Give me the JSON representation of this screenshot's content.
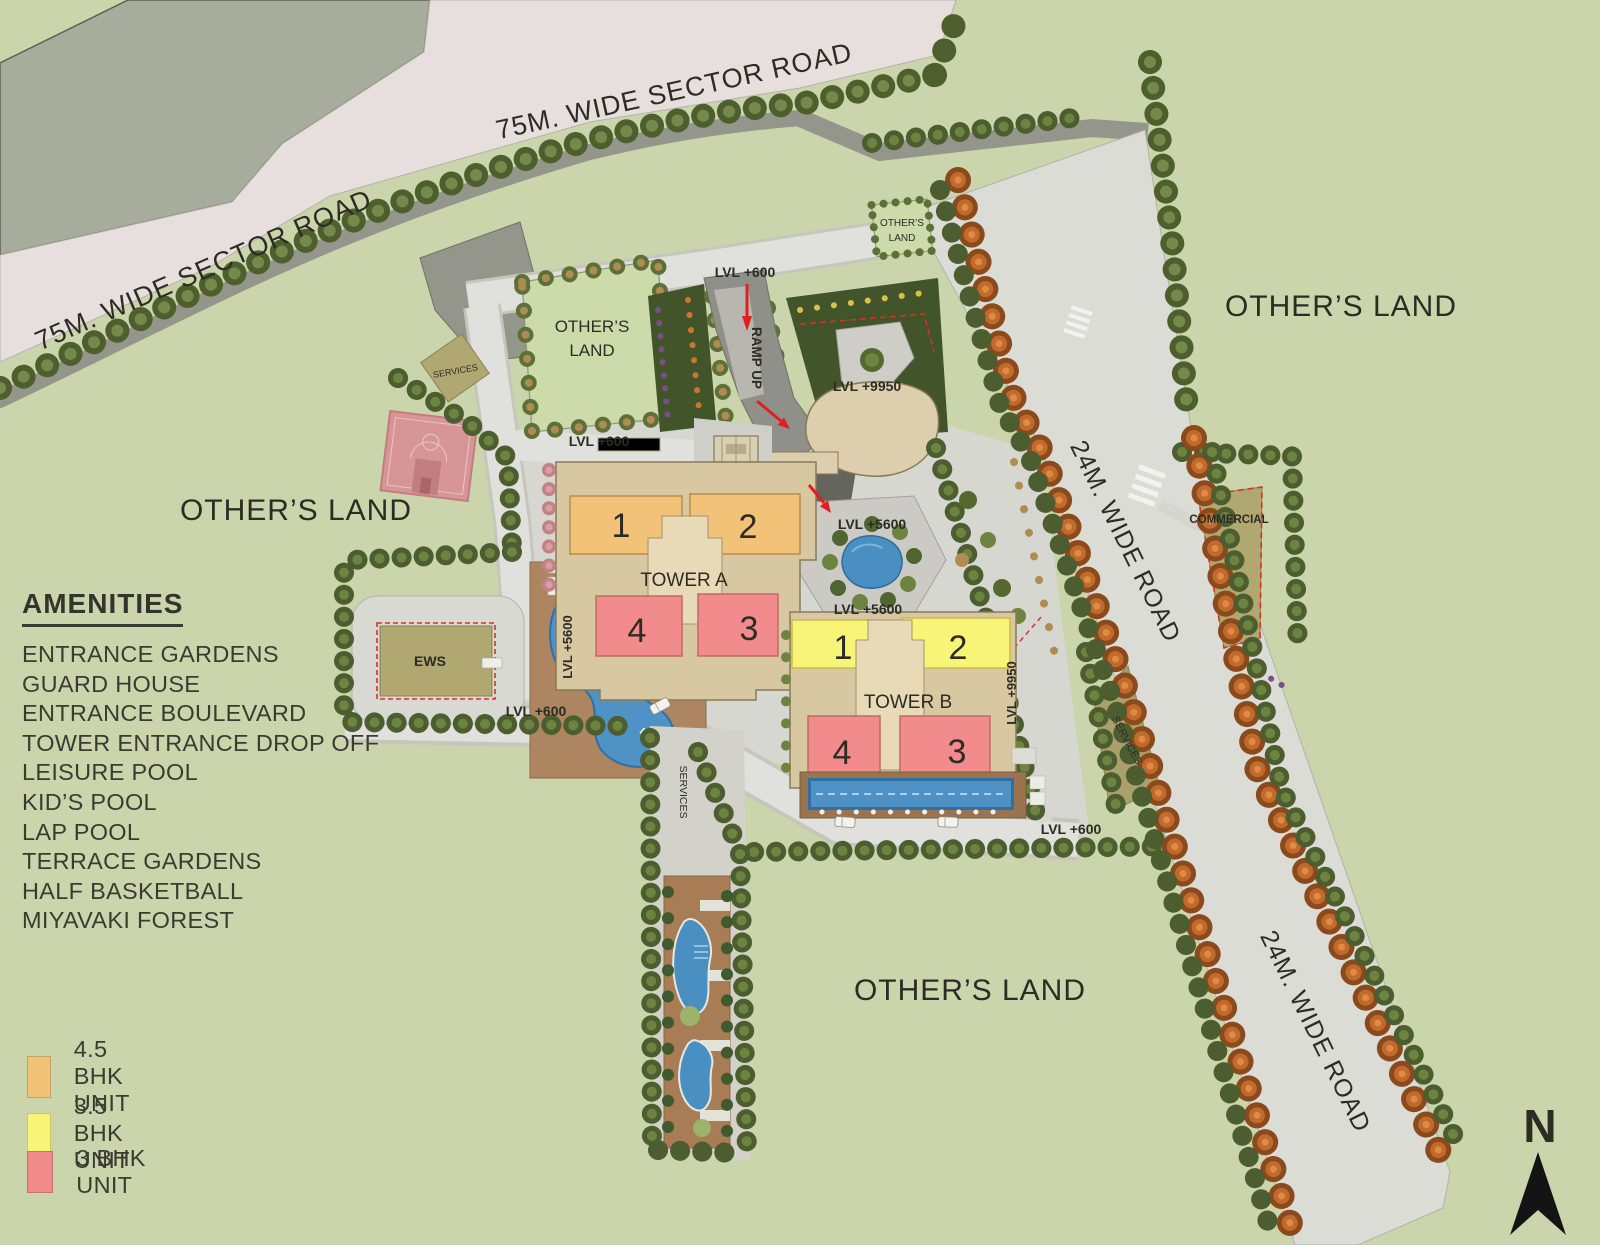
{
  "plan": {
    "amenities": {
      "title": "AMENITIES",
      "items": [
        "ENTRANCE GARDENS",
        "GUARD HOUSE",
        "ENTRANCE BOULEVARD",
        "TOWER ENTRANCE DROP OFF",
        "LEISURE POOL",
        "KID’S POOL",
        "LAP POOL",
        "TERRACE GARDENS",
        "HALF BASKETBALL",
        "MIYAVAKI FOREST"
      ]
    },
    "unit_legend": [
      {
        "label": "4.5 BHK UNIT",
        "color": "#f3c279"
      },
      {
        "label": "3.5 BHK UNIT",
        "color": "#f8f478"
      },
      {
        "label": "3 BHK UNIT",
        "color": "#f28b8b"
      }
    ],
    "roads": {
      "sector": "75M. WIDE SECTOR ROAD",
      "wide": "24M. WIDE ROAD"
    },
    "zones": {
      "others_land": "OTHER’S LAND",
      "others_line1": "OTHER’S",
      "others_line2": "LAND",
      "commercial": "COMMERCIAL",
      "ews": "EWS",
      "services": "SERVICES"
    },
    "levels": {
      "l600": "LVL +600",
      "l5600": "LVL +5600",
      "l9950": "LVL +9950"
    },
    "markers": {
      "ramp_up": "RAMP UP",
      "north": "N"
    },
    "towers": [
      {
        "name": "TOWER A",
        "units": [
          "1",
          "2",
          "4",
          "3"
        ]
      },
      {
        "name": "TOWER B",
        "units": [
          "1",
          "2",
          "4",
          "3"
        ]
      }
    ]
  }
}
